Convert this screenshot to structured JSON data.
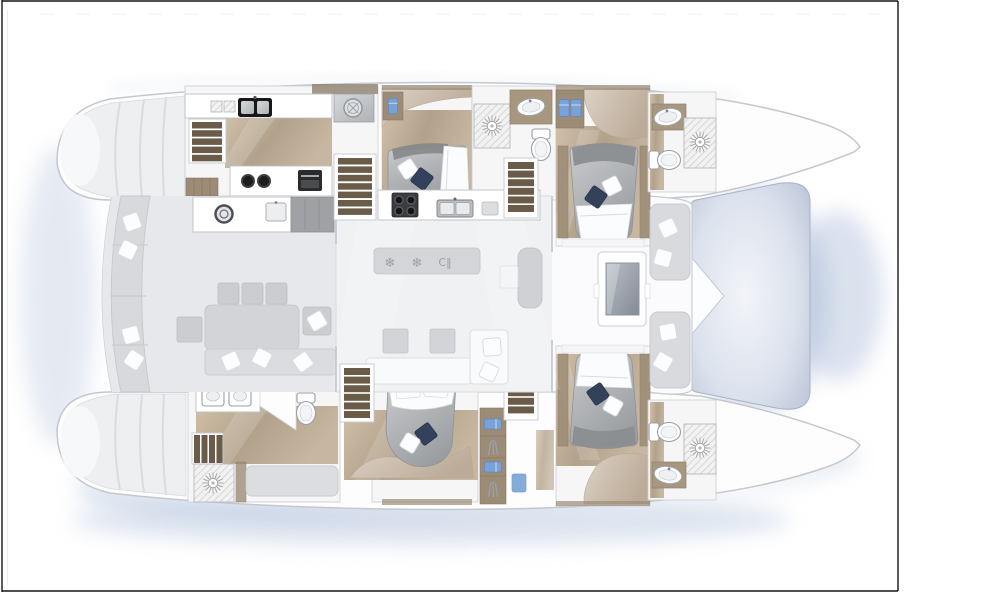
{
  "icons": {
    "snowflake": "❄",
    "wine_rack": "C‖"
  },
  "colors": {
    "frame": "#161616",
    "hull_outline": "#c3c8cf",
    "deck": "#fbfbfd",
    "cockpit_floor": "#e7e8eb",
    "saloon_floor": "#f0f1f2",
    "furniture_gray": "#d2d4d8",
    "sofa_white": "#f9fafb",
    "wood_light": "#c5b49d",
    "wood_dark": "#9c8c76",
    "stair_brown": "#6b5c4a",
    "bed_gray": "#abaeb1",
    "pillow_navy": "#33415a",
    "lining_tan": "#cbbcab",
    "towel_blue": "#79a3d8",
    "trampoline_blue": "#b7c2d6",
    "water_shadow": "#a9bad6",
    "appliance_black": "#1b1c1e"
  }
}
